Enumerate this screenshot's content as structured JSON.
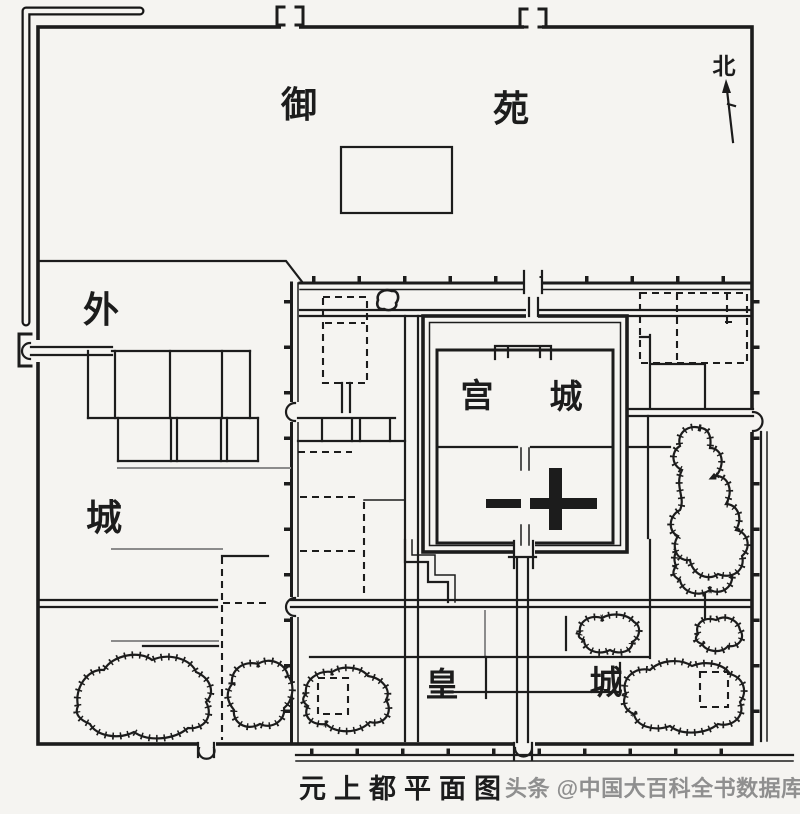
{
  "colors": {
    "background": "#f5f4f1",
    "ink": "#1c1c1c",
    "street_gray": "#8b8b8b",
    "watermark_gray": "#8f8f8f"
  },
  "regions": {
    "imperial_garden": {
      "label_char_1": "御",
      "label_char_2": "苑"
    },
    "outer_city": {
      "label_char_1": "外",
      "label_char_2": "城"
    },
    "palace_city": {
      "label_char_1": "宫",
      "label_char_2": "城"
    },
    "imperial_city": {
      "label_char_1": "皇",
      "label_char_2": "城"
    }
  },
  "compass": {
    "north_label": "北"
  },
  "caption": {
    "title": "元上都平面图"
  },
  "watermark": {
    "text": "头条 @中国大百科全书数据库"
  }
}
